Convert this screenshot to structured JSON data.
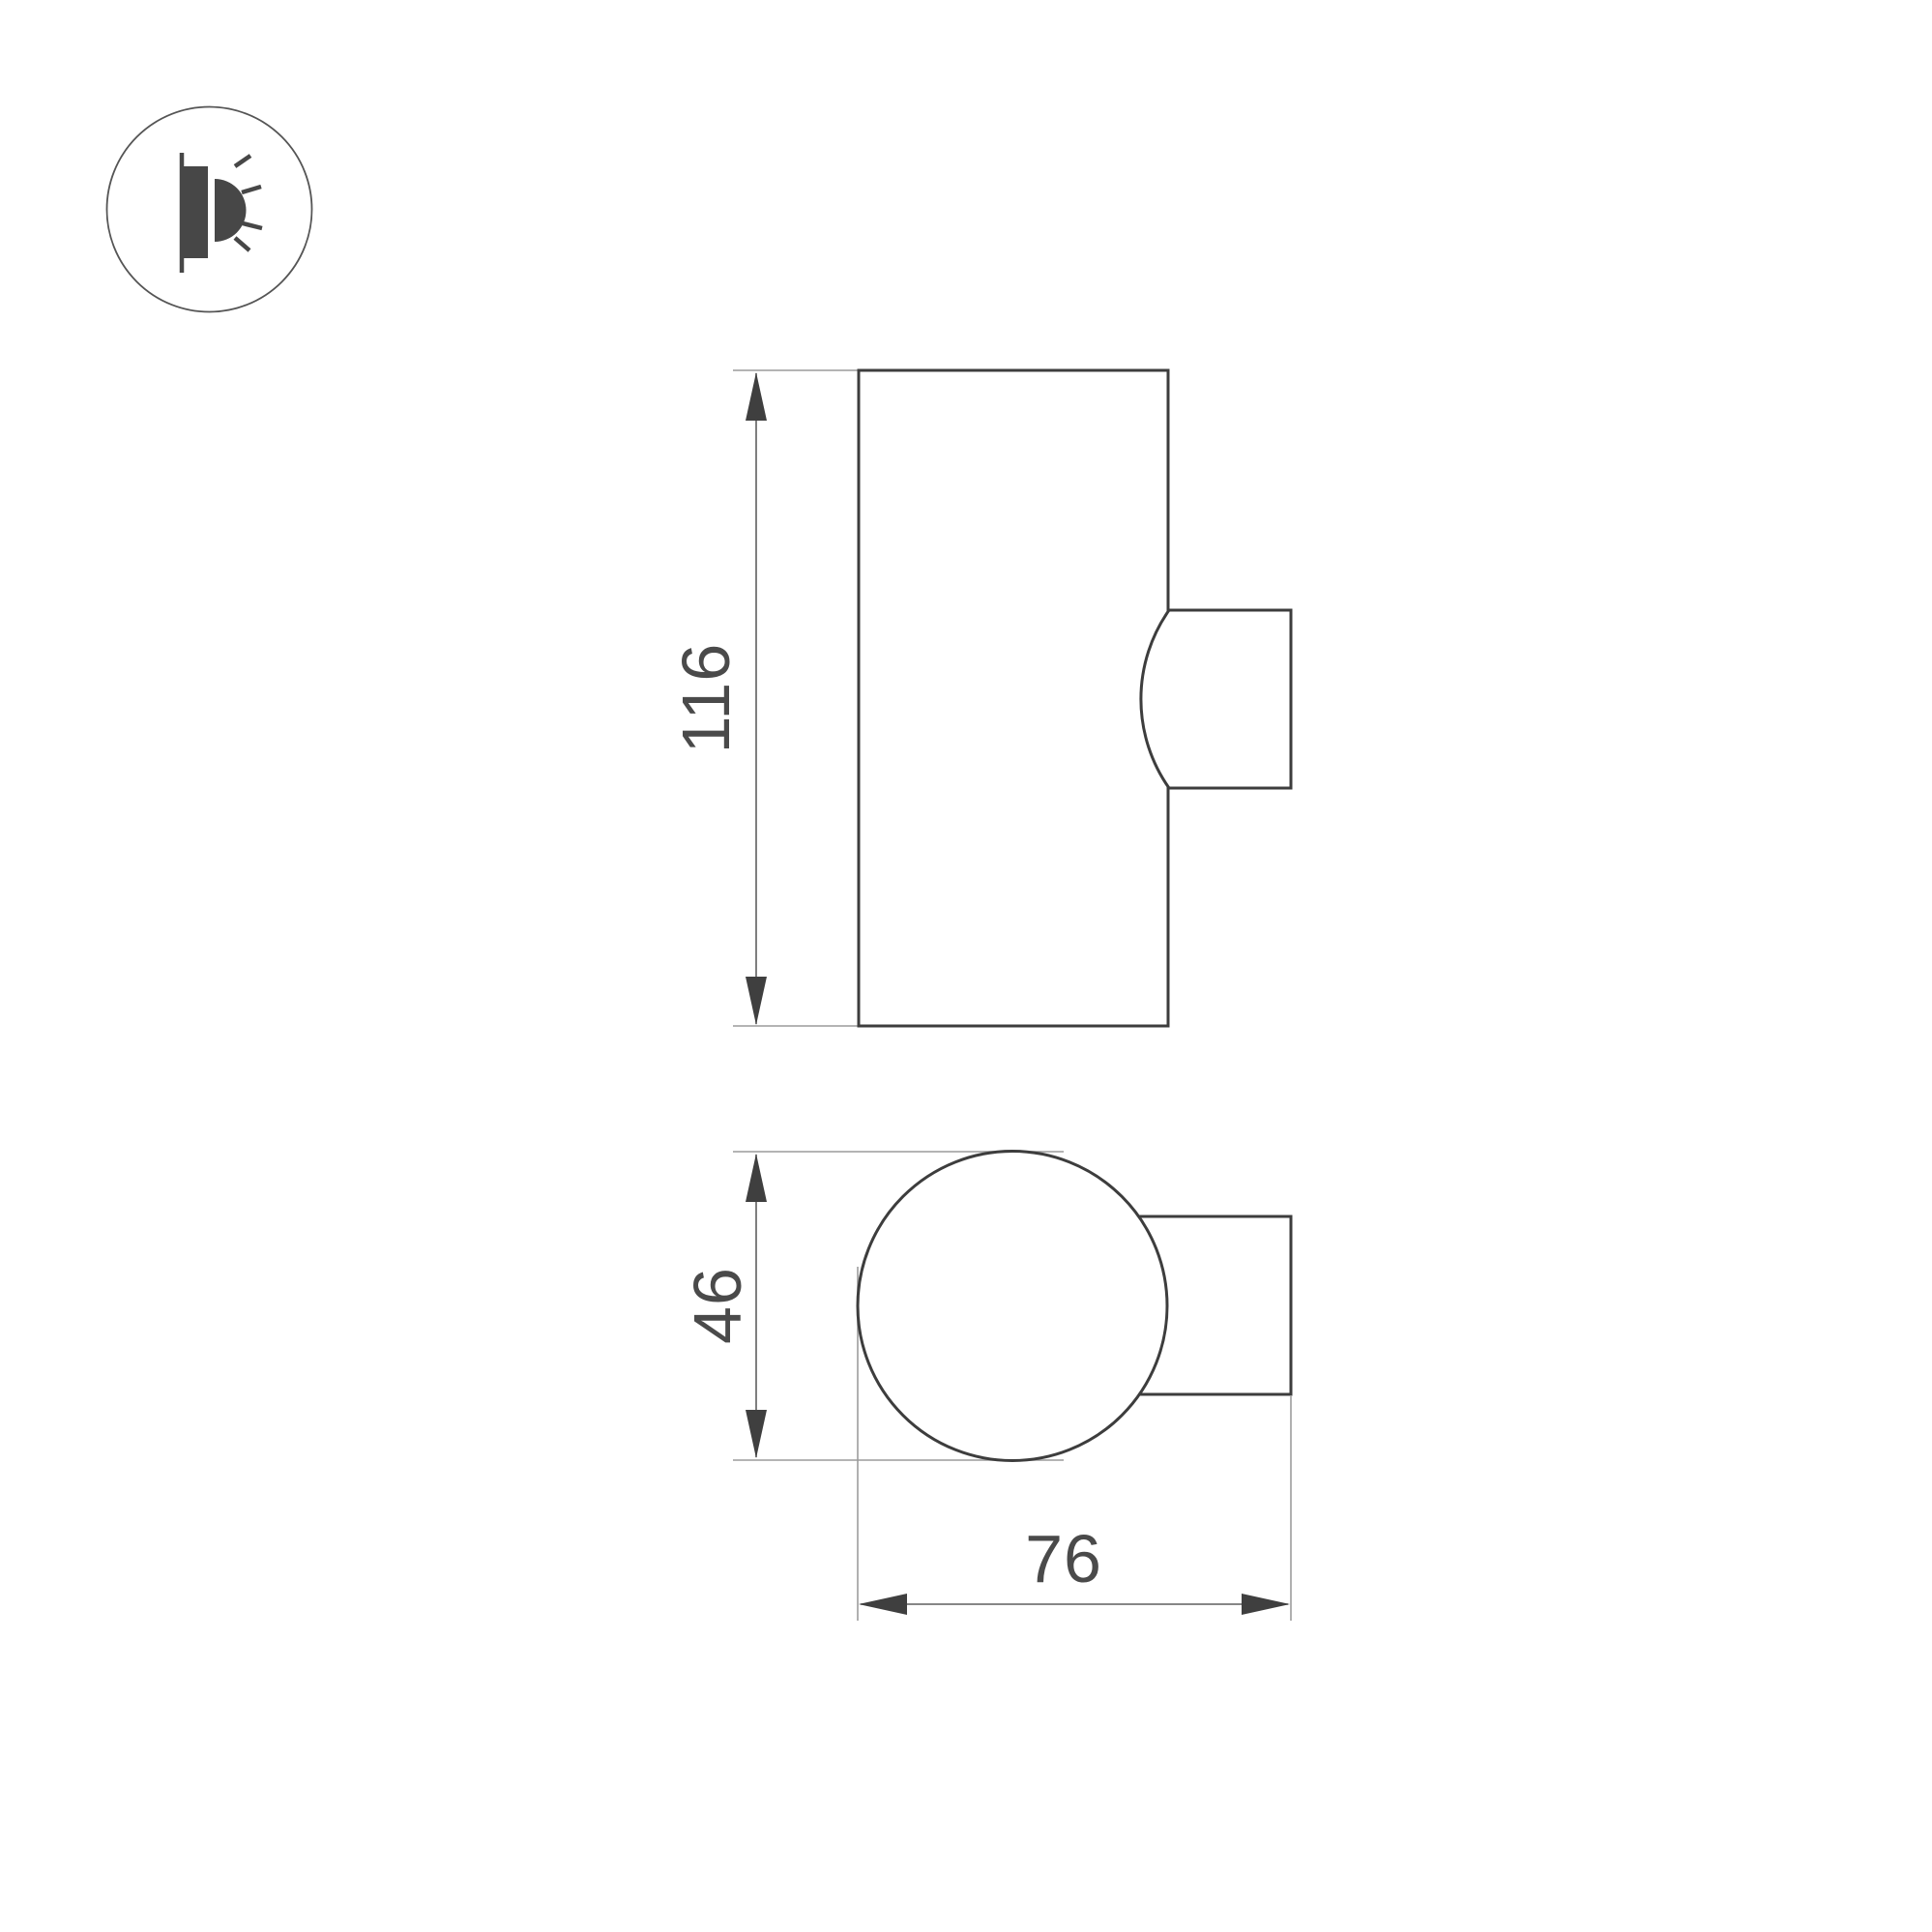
{
  "labels": {
    "front_height": "116",
    "profile_diameter": "46",
    "profile_depth": "76"
  },
  "icon": {
    "name": "wall-light-icon",
    "description": "surface wall luminaire pictogram"
  },
  "colors": {
    "background": "#ffffff",
    "outline": "#3d3d3d",
    "dimension_line": "#5f5f5f",
    "extension_line": "#9c9c9c",
    "arrow_fill": "#3f3f3f",
    "label_text": "#4a4a4a",
    "icon_glyph": "#474747",
    "icon_ring": "#555555"
  }
}
